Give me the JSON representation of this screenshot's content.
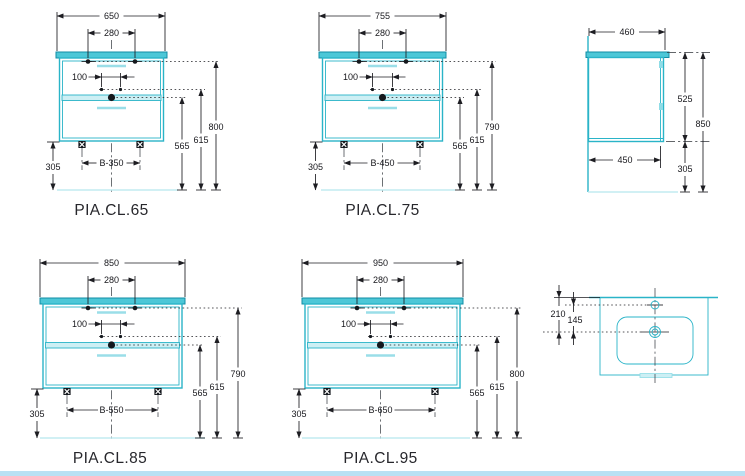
{
  "title": "Vanity cabinet technical dimension drawings",
  "units": [
    {
      "model": "PIA.CL.65",
      "width": "650",
      "faucet_spacing": "280",
      "drain_offset": "100",
      "feet_spacing": "B-350",
      "h_floor": "305",
      "h_drain": "565",
      "h_siphon": "615",
      "h_top": "800"
    },
    {
      "model": "PIA.CL.75",
      "width": "755",
      "faucet_spacing": "280",
      "drain_offset": "100",
      "feet_spacing": "B-450",
      "h_floor": "305",
      "h_drain": "565",
      "h_siphon": "615",
      "h_top": "790"
    },
    {
      "model": "PIA.CL.85",
      "width": "850",
      "faucet_spacing": "280",
      "drain_offset": "100",
      "feet_spacing": "B-550",
      "h_floor": "305",
      "h_drain": "565",
      "h_siphon": "615",
      "h_top": "790"
    },
    {
      "model": "PIA.CL.95",
      "width": "950",
      "faucet_spacing": "280",
      "drain_offset": "100",
      "feet_spacing": "B-650",
      "h_floor": "305",
      "h_drain": "565",
      "h_siphon": "615",
      "h_top": "800"
    }
  ],
  "side_view": {
    "width_top": "460",
    "height_body": "525",
    "height_total": "850",
    "width_bottom": "450",
    "height_floor": "305"
  },
  "top_view": {
    "back_to_drain": "210",
    "faucet_to_drain": "145"
  },
  "colors": {
    "cabinet_line": "#2ab4c8",
    "cabinet_fill": "#4cc7d7",
    "pale_fill": "#cdeff4",
    "dimension": "#1d1d22",
    "footer_bar": "#b9e1f3",
    "background": "#ffffff"
  }
}
